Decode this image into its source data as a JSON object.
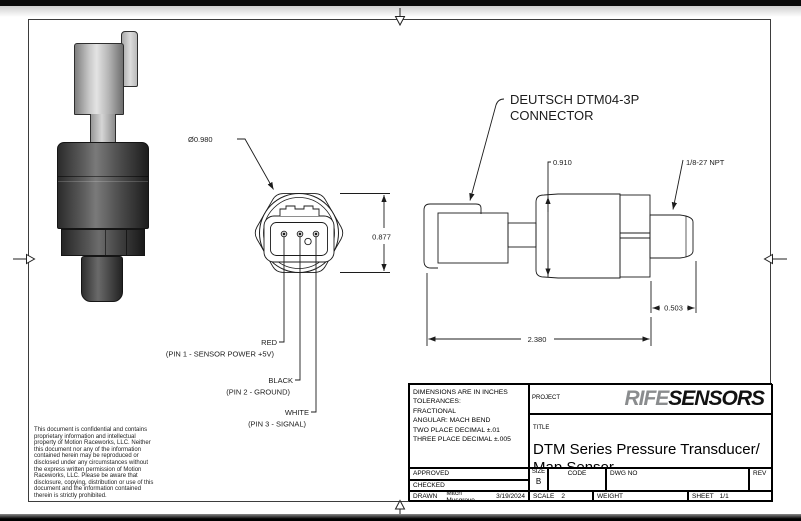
{
  "drawing": {
    "front_view": {
      "dia_label": "Ø0.980",
      "height_dim": "0.877",
      "pins": [
        {
          "color": "RED",
          "desc": "(PIN 1 - SENSOR POWER +5V)"
        },
        {
          "color": "BLACK",
          "desc": "(PIN 2 - GROUND)"
        },
        {
          "color": "WHITE",
          "desc": "(PIN 3 - SIGNAL)"
        }
      ]
    },
    "side_view": {
      "callout_line1": "DEUTSCH DTM04-3P",
      "callout_line2": "CONNECTOR",
      "height_dim": "0.910",
      "thread_label": "1/8-27 NPT",
      "thread_dim": "0.503",
      "overall_dim": "2.380"
    }
  },
  "notice": "This document is confidential and contains proprietary information and intellectual property of Motion Raceworks, LLC. Neither this document nor any of the information contained herein may be reproduced or disclosed under any circumstances without the express written permission of Motion Raceworks, LLC. Please be aware that disclosure, copying, distribution or use of this document and the information contained therein is strictly prohibited.",
  "title_block": {
    "tol_lines": [
      "DIMENSIONS ARE IN INCHES",
      "TOLERANCES:",
      "FRACTIONAL",
      "ANGULAR: MACH BEND",
      "TWO PLACE DECIMAL ±.01",
      "THREE PLACE DECIMAL ±.005"
    ],
    "project_label": "PROJECT",
    "logo": {
      "part1": "RIFE",
      "part2": "SENSORS",
      "part1_color": "#8a8c8e",
      "part2_color": "#111111"
    },
    "title_label": "TITLE",
    "title_line1": "DTM Series Pressure Transducer/",
    "title_line2": "Map Sensor",
    "approved_label": "APPROVED",
    "checked_label": "CHECKED",
    "drawn_label": "DRAWN",
    "drawn_by": "Mitch Musgrove",
    "drawn_date": "3/19/2024",
    "size_label": "SIZE",
    "size_value": "B",
    "code_label": "CODE",
    "dwgno_label": "DWG NO",
    "rev_label": "REV",
    "scale_label": "SCALE",
    "scale_value": "2",
    "weight_label": "WEIGHT",
    "sheet_label": "SHEET",
    "sheet_value": "1/1"
  }
}
